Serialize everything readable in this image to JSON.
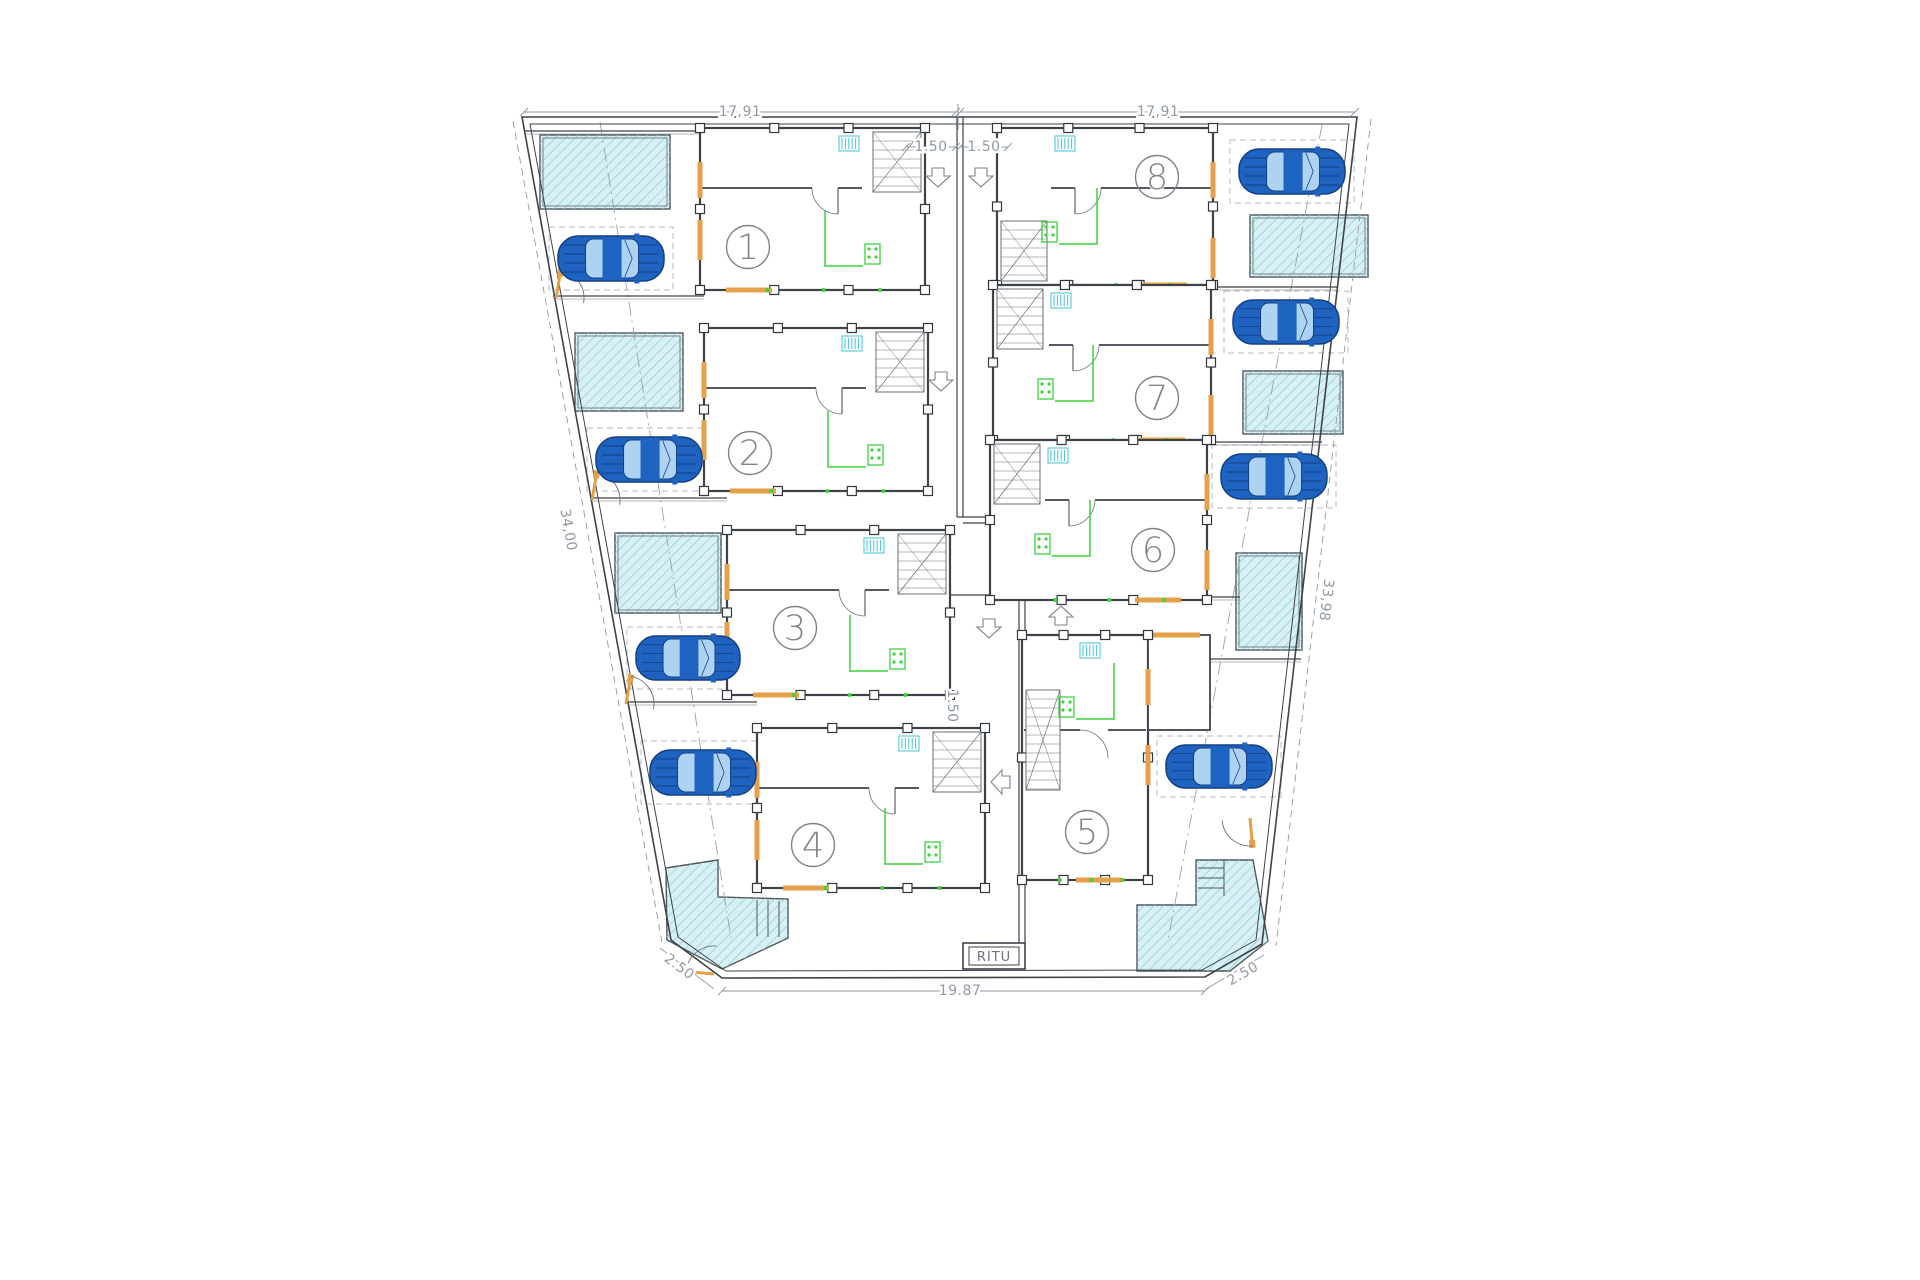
{
  "plan": {
    "title": "site floor plan with 8 dwelling units",
    "ritu_label": "RITU",
    "colors": {
      "wall": "#3e434a",
      "thin": "#6a7077",
      "dim": "#9099a2",
      "dash": "#b3b9c0",
      "orange": "#e5a049",
      "green": "#3bd23b",
      "cyan": "#41c4d8",
      "pool_fill": "#d8f0f3",
      "pool_hatch": "#8bd0db",
      "pool_edge": "#50565c",
      "car_body": "#1e63c0",
      "car_dark": "#123f85",
      "car_window": "#aed3f2",
      "circle": "#7e838a"
    },
    "boundary": {
      "outer": "522,117 1357,117 1262,944 1205,977 722,978 671,940",
      "inner": "530,124 1349,124 1256,940 1202,970 726,971 678,937"
    },
    "units": [
      {
        "n": "1",
        "block": [
          700,
          128,
          225,
          162
        ],
        "circle": [
          748,
          247
        ],
        "stair": "tr",
        "side": "L"
      },
      {
        "n": "2",
        "block": [
          704,
          328,
          224,
          163
        ],
        "circle": [
          750,
          453
        ],
        "stair": "tr",
        "side": "L"
      },
      {
        "n": "3",
        "block": [
          727,
          530,
          223,
          165
        ],
        "circle": [
          795,
          628
        ],
        "stair": "tr",
        "side": "L"
      },
      {
        "n": "4",
        "block": [
          757,
          728,
          228,
          160
        ],
        "circle": [
          813,
          845
        ],
        "stair": "tr",
        "side": "L"
      },
      {
        "n": "8",
        "block": [
          997,
          128,
          216,
          157
        ],
        "circle": [
          1157,
          177
        ],
        "stair": "bl",
        "side": "R"
      },
      {
        "n": "7",
        "block": [
          993,
          285,
          218,
          155
        ],
        "circle": [
          1157,
          398
        ],
        "stair": "tl",
        "side": "R"
      },
      {
        "n": "6",
        "block": [
          990,
          440,
          217,
          160
        ],
        "circle": [
          1153,
          550
        ],
        "stair": "tl",
        "side": "R"
      },
      {
        "n": "5",
        "block": [
          1022,
          635,
          126,
          245
        ],
        "circle": [
          1087,
          832
        ],
        "stair": "tall",
        "side": "R",
        "annex": [
          1148,
          635,
          62,
          95
        ]
      }
    ],
    "cars": [
      [
        558,
        236,
        106,
        45
      ],
      [
        596,
        437,
        106,
        45
      ],
      [
        636,
        636,
        104,
        44
      ],
      [
        650,
        750,
        106,
        45
      ],
      [
        1239,
        149,
        106,
        45
      ],
      [
        1233,
        300,
        106,
        44
      ],
      [
        1221,
        454,
        106,
        45
      ],
      [
        1166,
        745,
        106,
        43
      ]
    ],
    "pools": {
      "rects": [
        [
          540,
          135,
          130,
          74
        ],
        [
          575,
          333,
          108,
          78
        ],
        [
          615,
          533,
          106,
          80
        ],
        [
          1250,
          215,
          118,
          62
        ],
        [
          1243,
          371,
          100,
          63
        ],
        [
          1236,
          553,
          66,
          97
        ]
      ],
      "polys": [
        "666,868 718,860 718,897 788,899 788,938 722,969 667,940",
        "1137,905 1196,905 1196,860 1253,860 1268,941 1230,971 1137,971"
      ],
      "steps_bl": [
        [
          757,
          900,
          757,
          936
        ],
        [
          768,
          900,
          768,
          937
        ],
        [
          779,
          901,
          779,
          937
        ]
      ],
      "steps_br": [
        [
          1198,
          868,
          1224,
          868
        ],
        [
          1198,
          878,
          1224,
          878
        ],
        [
          1198,
          888,
          1224,
          888
        ],
        [
          1224,
          860,
          1224,
          896
        ]
      ]
    },
    "dimensions": [
      {
        "t": "17,91",
        "x": 740,
        "y": 112,
        "rot": 0,
        "line": [
          524,
          112,
          956,
          112
        ],
        "ticks": 1
      },
      {
        "t": "17,91",
        "x": 1158,
        "y": 112,
        "rot": 0,
        "line": [
          960,
          112,
          1355,
          112
        ],
        "ticks": 1
      },
      {
        "t": "1.50",
        "x": 931,
        "y": 147,
        "rot": 0,
        "line": [
          906,
          147,
          956,
          147
        ],
        "ticks": 1
      },
      {
        "t": "1.50",
        "x": 984,
        "y": 147,
        "rot": 0,
        "line": [
          960,
          147,
          1008,
          147
        ],
        "ticks": 1
      },
      {
        "t": "34,00",
        "x": 568,
        "y": 530,
        "rot": 80,
        "line": [
          513,
          121,
          662,
          942
        ],
        "dash": 1
      },
      {
        "t": "33,98",
        "x": 1326,
        "y": 600,
        "rot": 97,
        "line": [
          1371,
          119,
          1276,
          946
        ],
        "dash": 1
      },
      {
        "t": "1.50",
        "x": 952,
        "y": 706,
        "rot": 90,
        "line": null
      },
      {
        "t": "19.87",
        "x": 960,
        "y": 991,
        "rot": 0,
        "line": [
          722,
          991,
          1205,
          991
        ],
        "ticks": 1
      },
      {
        "t": "2.50",
        "x": 679,
        "y": 967,
        "rot": 37,
        "line": [
          660,
          948,
          714,
          989
        ]
      },
      {
        "t": "2.50",
        "x": 1243,
        "y": 974,
        "rot": -30,
        "line": [
          1206,
          989,
          1264,
          955
        ]
      }
    ],
    "top_tick": [
      958,
      104,
      958,
      130
    ],
    "fences": [
      [
        524,
        131,
        700,
        131
      ],
      [
        553,
        296,
        704,
        296
      ],
      [
        590,
        498,
        727,
        498
      ],
      [
        628,
        702,
        757,
        702
      ],
      [
        1213,
        287,
        1338,
        287
      ],
      [
        1210,
        442,
        1322,
        442
      ],
      [
        1140,
        597,
        1240,
        597
      ],
      [
        1210,
        659,
        1301,
        659
      ]
    ],
    "corridor": [
      [
        957,
        117,
        957,
        517
      ],
      [
        963,
        117,
        963,
        517
      ],
      [
        957,
        517,
        1022,
        517
      ],
      [
        963,
        523,
        1022,
        523
      ],
      [
        1019,
        517,
        1019,
        944
      ],
      [
        1025,
        517,
        1025,
        944
      ],
      [
        950,
        595,
        1022,
        595
      ]
    ],
    "centerlines": [
      [
        600,
        122,
        731,
        938
      ],
      [
        1322,
        125,
        1168,
        940
      ]
    ],
    "doors": [
      {
        "x": 556,
        "y": 298,
        "r": 10
      },
      {
        "x": 592,
        "y": 500,
        "r": 10
      },
      {
        "x": 626,
        "y": 704,
        "r": 10
      },
      {
        "x": 714,
        "y": 974,
        "r": -85
      },
      {
        "x": 1250,
        "y": 818,
        "r": 175
      }
    ],
    "arrows": [
      {
        "x": 938,
        "y": 177,
        "r": 0
      },
      {
        "x": 981,
        "y": 177,
        "r": 0
      },
      {
        "x": 941,
        "y": 381,
        "r": 0
      },
      {
        "x": 989,
        "y": 628,
        "r": 0
      },
      {
        "x": 1061,
        "y": 616,
        "r": 180
      },
      {
        "x": 1001,
        "y": 782,
        "r": 90
      }
    ],
    "ritu_box": {
      "outer": [
        963,
        943,
        62,
        26
      ],
      "inner": [
        969,
        947,
        50,
        18
      ],
      "tx": 994,
      "ty": 961
    }
  }
}
